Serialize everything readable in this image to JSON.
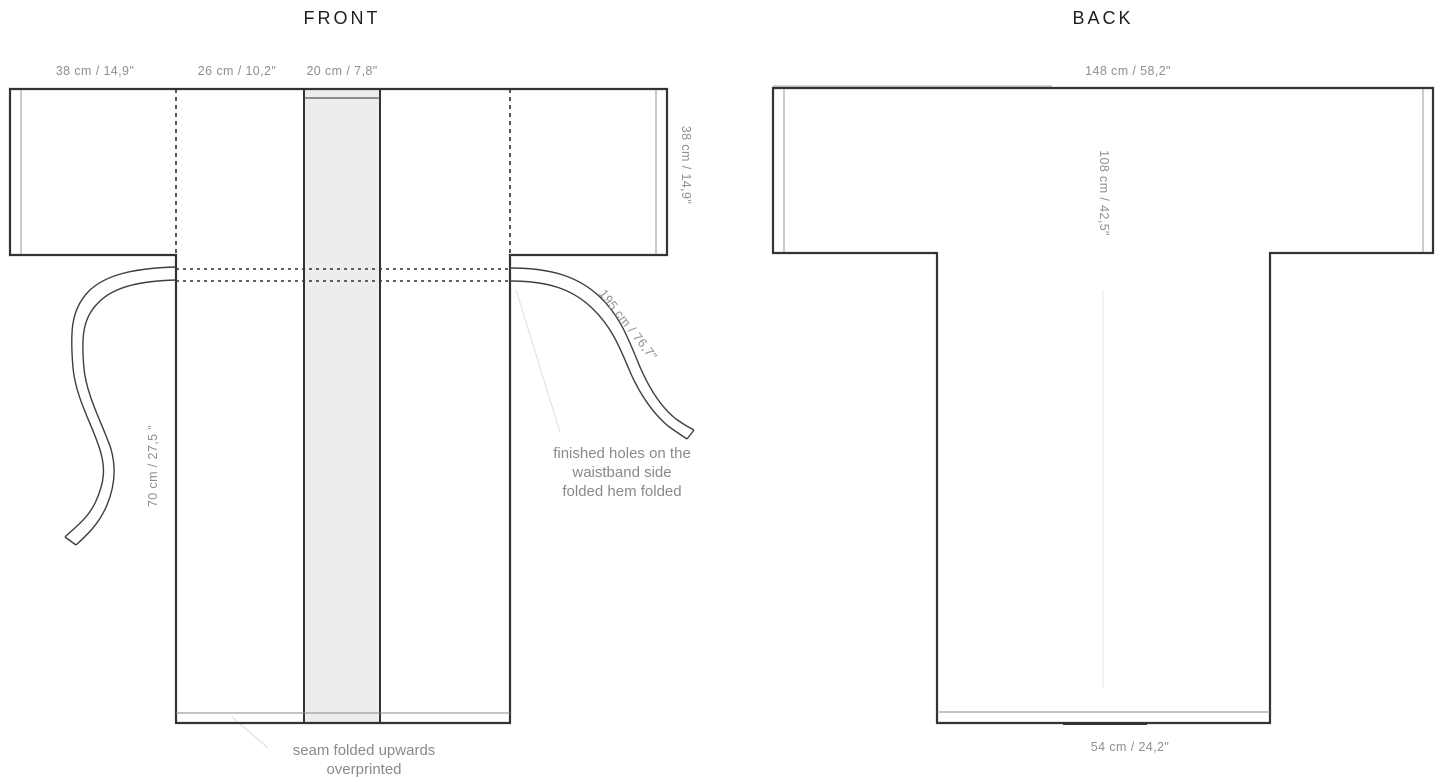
{
  "front": {
    "title": "FRONT",
    "dims": {
      "sleeve_top": "38 cm / 14,9\"",
      "shoulder_top": "26 cm / 10,2\"",
      "band_top": "20 cm / 7,8\"",
      "sleeve_right": "38 cm / 14,9\"",
      "belt_right": "195 cm / 76,7\"",
      "belt_left": "70 cm / 27,5 \""
    },
    "caption_holes": [
      "finished holes on the",
      "waistband side",
      "folded hem folded"
    ],
    "caption_seam": [
      "seam folded upwards",
      "overprinted"
    ]
  },
  "back": {
    "title": "BACK",
    "dims": {
      "width_top": "148  cm / 58,2\"",
      "length_center": "108 cm / 42,5\"",
      "hem_bottom": "54  cm / 24,2\""
    }
  },
  "colors": {
    "outline": "#333333",
    "thin_line": "#999999",
    "band_fill": "#ededed",
    "label_text": "#8f8f8f",
    "title_text": "#1e1e1e"
  }
}
